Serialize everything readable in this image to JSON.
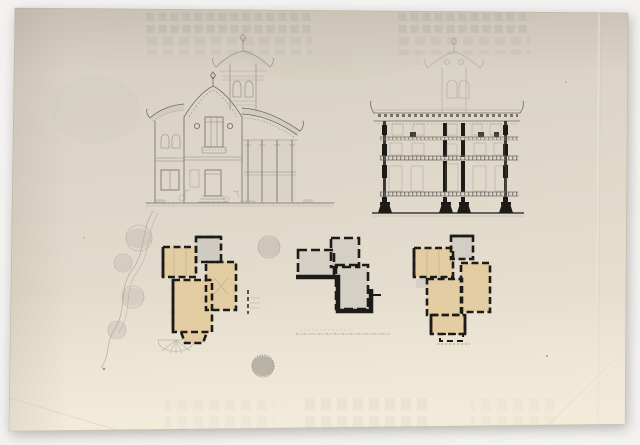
{
  "canvas": {
    "width": 640,
    "height": 445,
    "background": "#f3f2f1"
  },
  "colors": {
    "paper_top": "#d5cec1",
    "paper_mid": "#ded7c9",
    "paper_bottom": "#eae2d2",
    "paper_edge": "#c0b8a8",
    "graphite": "#6f6a62",
    "graphite_faint": "#9a948a",
    "poche_black": "#1d1b18",
    "wash_tan": "#e2c897",
    "wash_gray": "#c7c4bf",
    "ghost_gray": "#8f8b84"
  },
  "sheet": {
    "panels": [
      {
        "id": "elevation",
        "kind": "front-elevation-chinese-style-villa"
      },
      {
        "id": "section",
        "kind": "cross-section-with-tower"
      },
      {
        "id": "plan-left",
        "kind": "floor-plan-tan-wash"
      },
      {
        "id": "plan-center",
        "kind": "floor-plan-gray-wash"
      },
      {
        "id": "plan-right",
        "kind": "floor-plan-tan-wash"
      },
      {
        "id": "landscape",
        "kind": "garden-path-and-trees-sketch"
      }
    ]
  }
}
